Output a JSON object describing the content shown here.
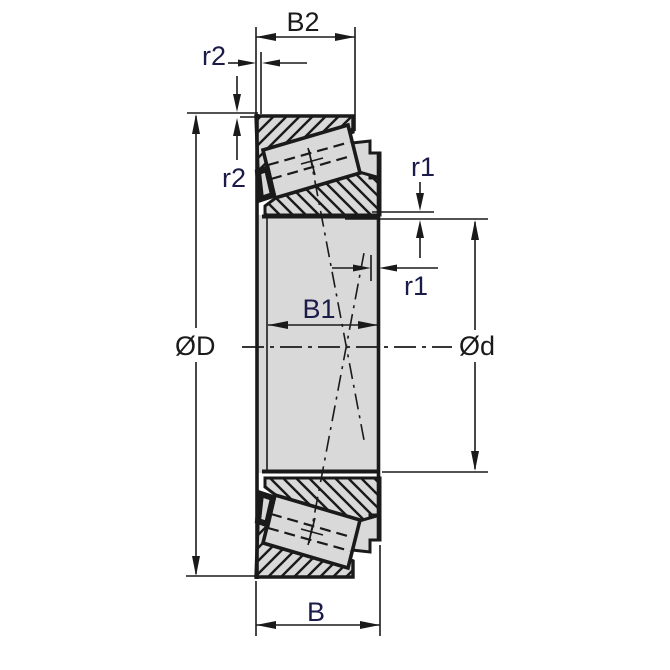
{
  "drawing": {
    "type": "tapered-roller-bearing-cross-section",
    "labels": {
      "b2": "B2",
      "r2_top": "r2",
      "r2_side": "r2",
      "r1_top": "r1",
      "r1_side": "r1",
      "b1": "B1",
      "outer_diameter": "ØD",
      "bore_diameter": "Ød",
      "b": "B"
    },
    "colors": {
      "line": "#1a1a1a",
      "label_navy": "#1b1b4a",
      "label_black": "#1a1a1a",
      "section_fill": "#d9d9d9",
      "background": "#ffffff"
    }
  }
}
